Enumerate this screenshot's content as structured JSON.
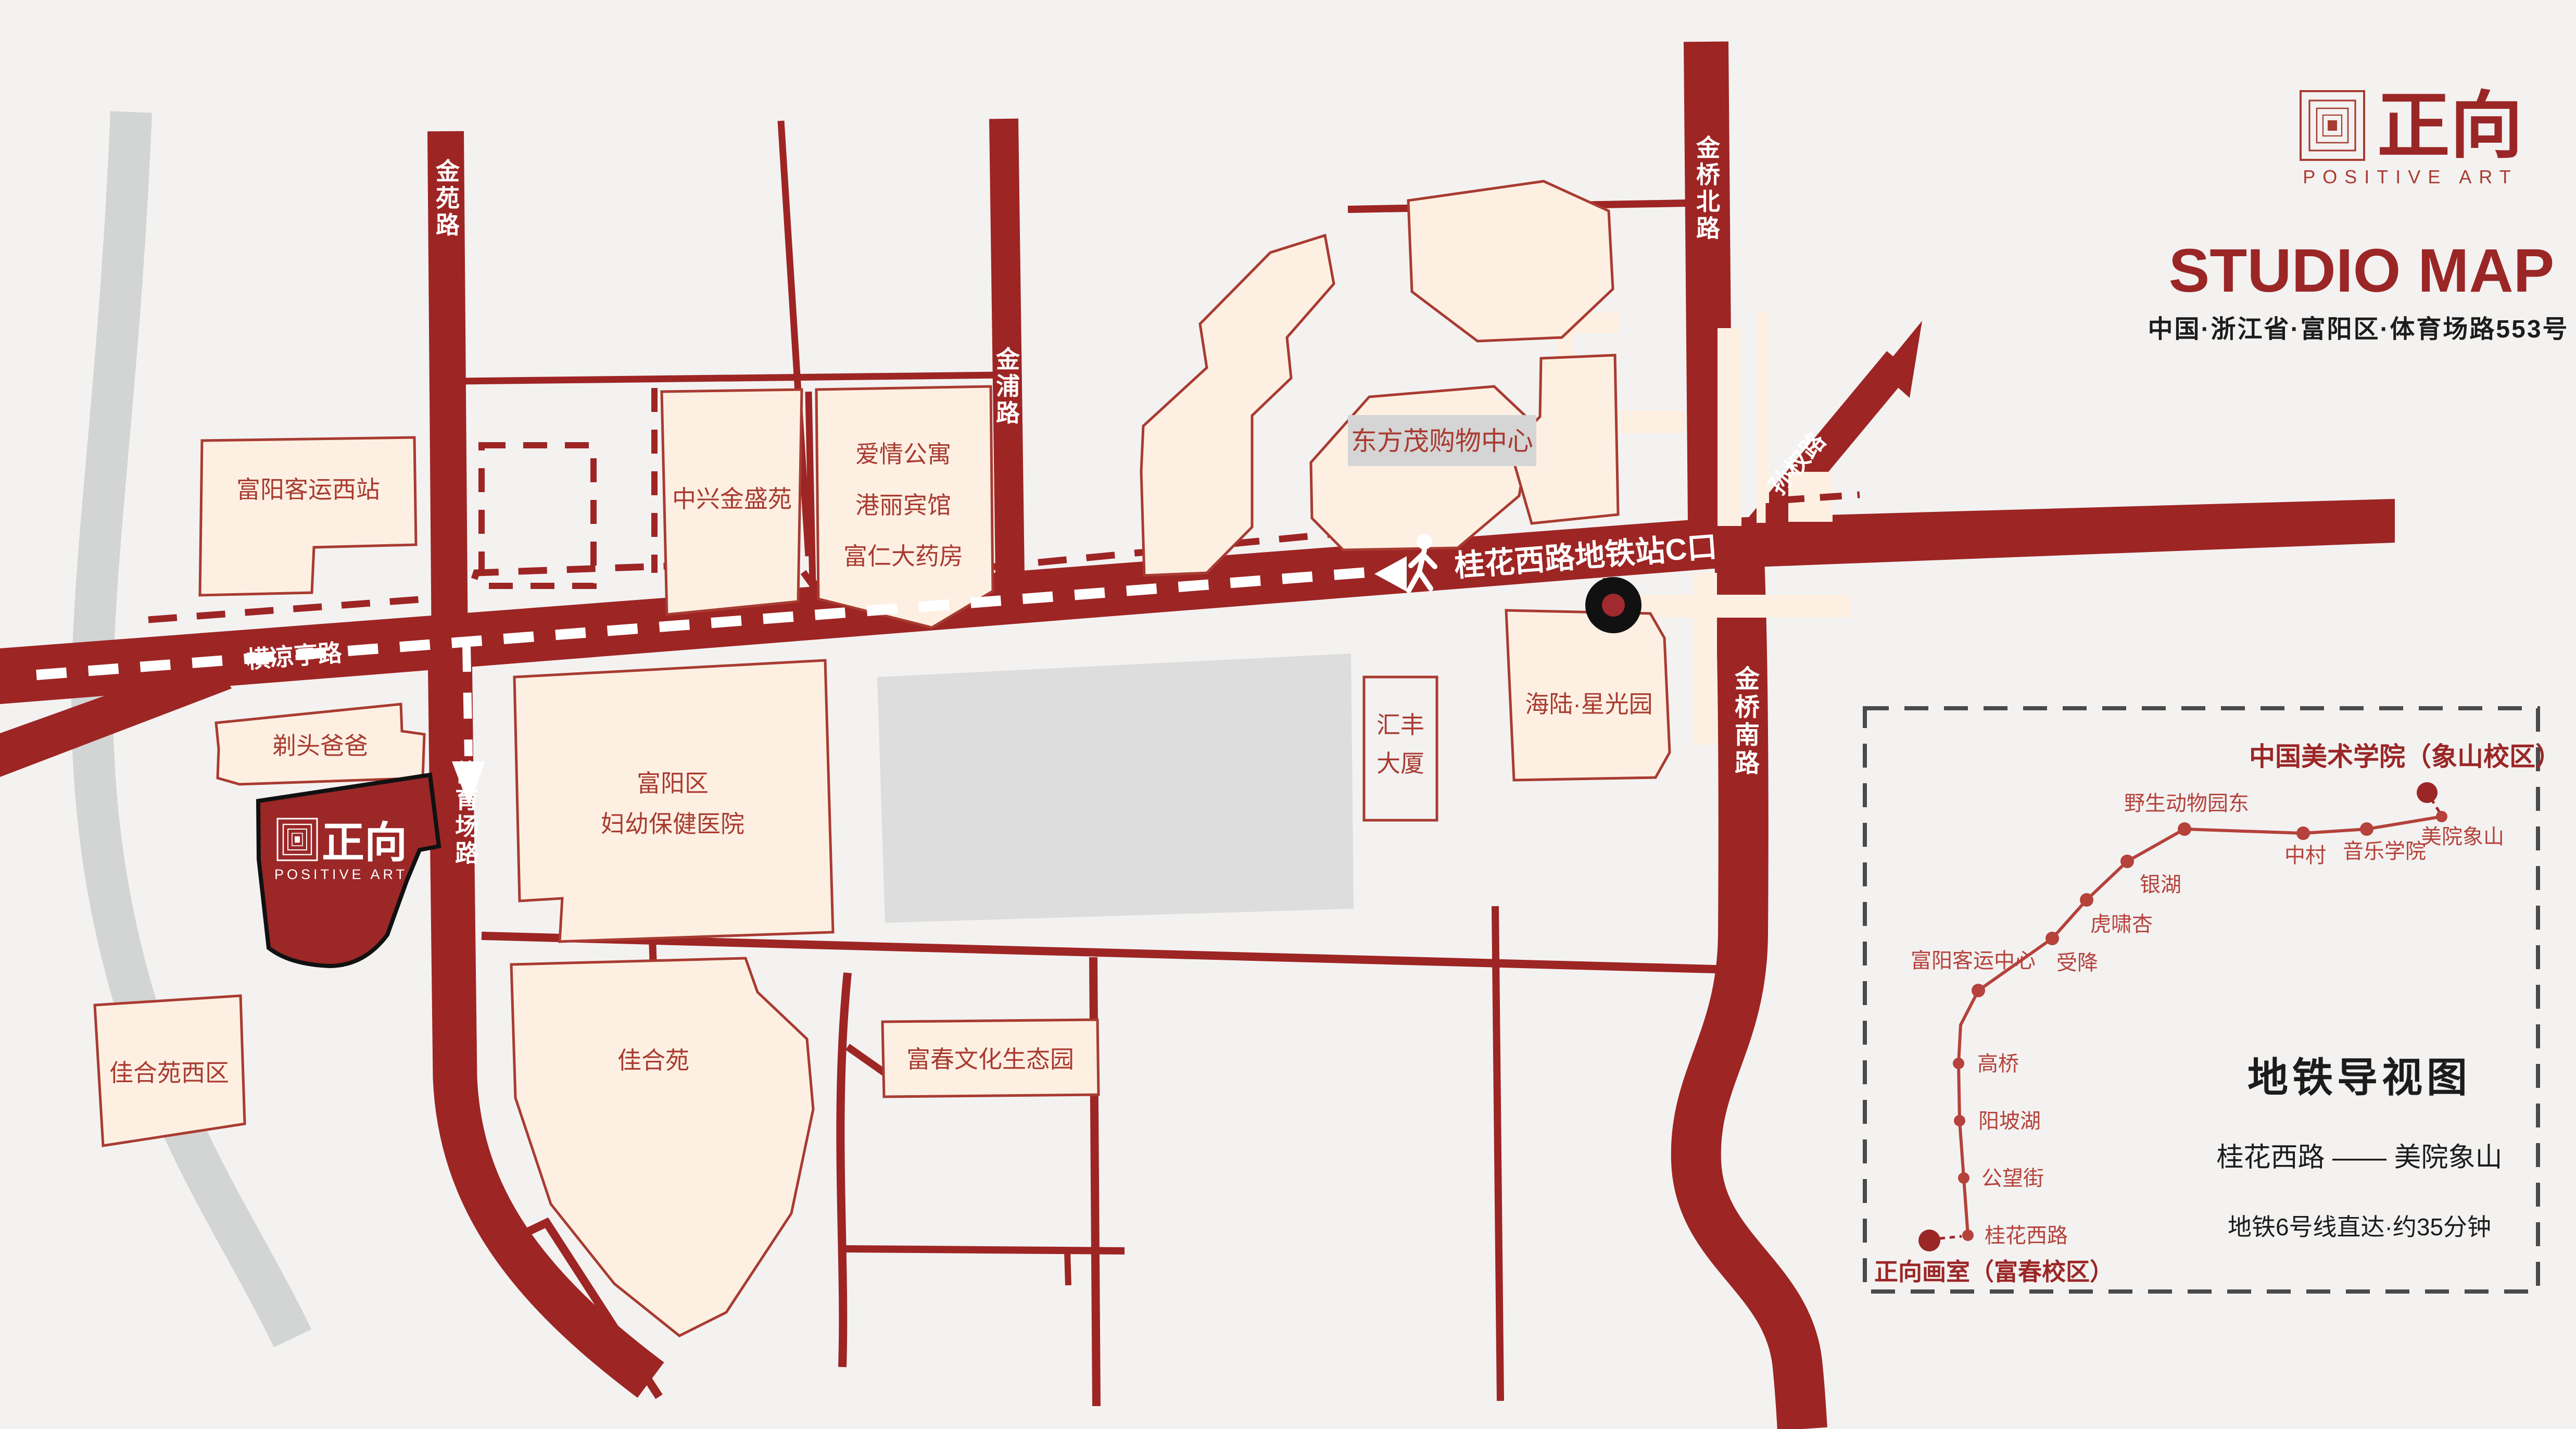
{
  "brand": {
    "name_cn": "正向",
    "name_en": "POSITIVE ART"
  },
  "header": {
    "title": "STUDIO MAP",
    "address": "中国·浙江省·富阳区·体育场路553号"
  },
  "map": {
    "roads": {
      "jinyuan": "金苑路",
      "hengliangting": "横凉亭路",
      "tiyuchang": "体育场路",
      "jinpu": "金浦路",
      "jinqiao_north": "金桥北路",
      "sunquan": "孙权路",
      "jinqiao_south": "金桥南路"
    },
    "station_callout": "桂花西路地铁站C口",
    "buildings": {
      "west_bus_station": "富阳客运西站",
      "zhongxing": "中兴金盛苑",
      "love_apartment": "爱情公寓",
      "gangli_hotel": "港丽宾馆",
      "furen_pharmacy": "富仁大药房",
      "dongfangmao": "东方茂购物中心",
      "huifeng": "汇丰",
      "huifeng2": "大厦",
      "hailu": "海陆·星光园",
      "hospital_line1": "富阳区",
      "hospital_line2": "妇幼保健医院",
      "titou_baba": "剃头爸爸",
      "jiaheyuan_west": "佳合苑西区",
      "jiaheyuan": "佳合苑",
      "fuchun_park": "富春文化生态园"
    },
    "studio": {
      "name_cn": "正向",
      "name_en": "POSITIVE ART"
    }
  },
  "metro_panel": {
    "title": "地铁导视图",
    "origin_label": "正向画室（富春校区）",
    "terminus_label": "中国美术学院（象山校区）",
    "route": "桂花西路 —— 美院象山",
    "note": "地铁6号线直达·约35分钟",
    "stations": [
      "桂花西路",
      "公望街",
      "阳坡湖",
      "高桥",
      "富阳客运中心",
      "受降",
      "虎啸杏",
      "银湖",
      "野生动物园东",
      "中村",
      "音乐学院",
      "美院象山"
    ]
  },
  "colors": {
    "road": "#9d2524",
    "building_fill": "#fdf0e3",
    "building_stroke": "#a93b31",
    "accent": "#9b2626",
    "metro_line": "#b5423b",
    "background": "#f3f2f1"
  }
}
